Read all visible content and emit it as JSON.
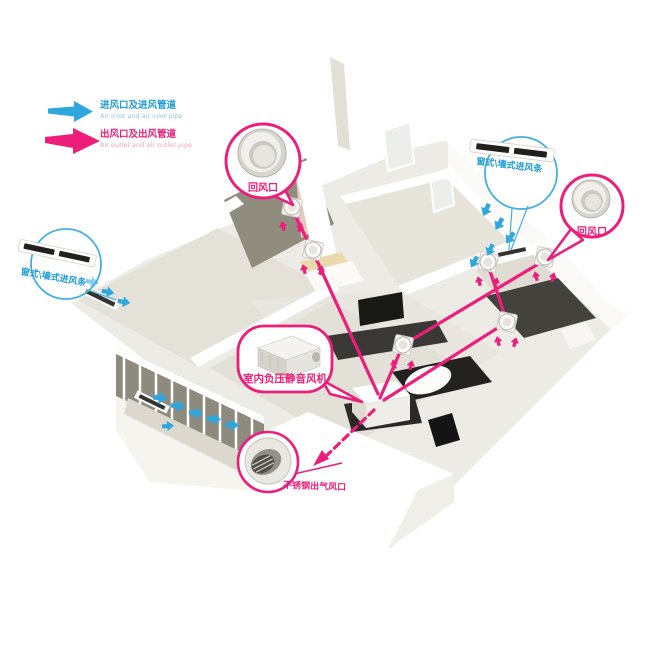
{
  "legend": {
    "items": [
      {
        "id": "inlet",
        "zh": "进风口及进风管道",
        "en": "Air inlet and air inlet pipe"
      },
      {
        "id": "outlet",
        "zh": "出风口及出风管道",
        "en": "Air outlet and air outlet pipe"
      }
    ]
  },
  "callouts": {
    "return_air_top": {
      "label": "回风口"
    },
    "inlet_strip_right": {
      "label": "窗式\\墙式进风条"
    },
    "return_air_right": {
      "label": "回风口"
    },
    "inlet_strip_left": {
      "label": "窗式\\墙式进风条"
    },
    "fan_unit": {
      "label": "室内负压静音风机"
    },
    "steel_outlet": {
      "label": "不锈钢出气风口"
    }
  },
  "colors": {
    "inlet_blue": "#1E9CD8",
    "outlet_magenta": "#EC1E79"
  }
}
